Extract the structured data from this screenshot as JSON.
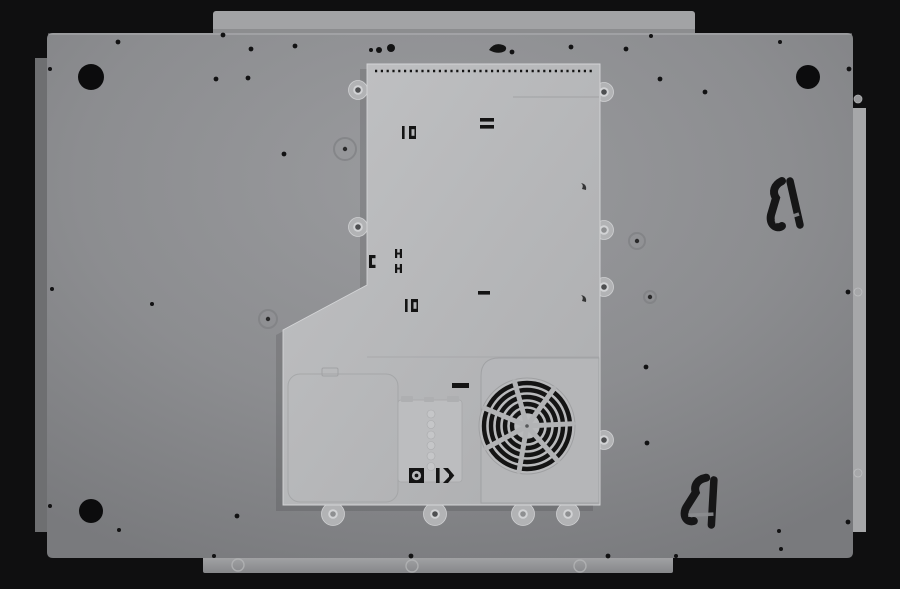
{
  "colors": {
    "bg": "#0f0f10",
    "panel-light": "#9a9b9e",
    "panel-mid": "#8c8d90",
    "panel-dark": "#7b7c7f",
    "flange-left": "#6e6f71",
    "flange-right": "#a6a7a9",
    "strip-top": "#a2a3a5",
    "strip-bottom-light": "#a4a5a7",
    "strip-bottom-dark": "#8a8b8d",
    "enclosure-light": "#bfc0c2",
    "enclosure-mid": "#b2b3b5",
    "plate": "#b6b7b9",
    "junction-cover": "#bcbdbf",
    "seam": "#9fa0a2",
    "edge-highlight": "#d6d7d9",
    "cutout-black": "#141414",
    "screw-ring": "#d2d3d5",
    "screw-dark": "#4e4f51",
    "screw-light": "#8e8f91"
  },
  "geometry": {
    "stage": {
      "w": 900,
      "h": 589
    },
    "glass_strip_top": {
      "x": 213,
      "y": 11,
      "w": 482,
      "h": 23
    },
    "glass_strip_bottom": {
      "x": 203,
      "y": 556,
      "w": 470,
      "h": 17,
      "notches": [
        [
          238,
          565
        ],
        [
          412,
          566
        ],
        [
          580,
          566
        ]
      ]
    },
    "corner_holes": [
      [
        91,
        77,
        13
      ],
      [
        808,
        77,
        12
      ],
      [
        91,
        511,
        12
      ]
    ],
    "screw_dots": [
      [
        118,
        42,
        2.4
      ],
      [
        223,
        35,
        2.4
      ],
      [
        251,
        49,
        2.4
      ],
      [
        295,
        46,
        2.4
      ],
      [
        50,
        69,
        2
      ],
      [
        216,
        79,
        2.4
      ],
      [
        248,
        78,
        2.4
      ],
      [
        284,
        154,
        2.4
      ],
      [
        152,
        304,
        2
      ],
      [
        52,
        289,
        2
      ],
      [
        50,
        506,
        2
      ],
      [
        119,
        530,
        2
      ],
      [
        237,
        516,
        2.4
      ],
      [
        214,
        556,
        2
      ],
      [
        411,
        556,
        2.4
      ],
      [
        608,
        556,
        2.4
      ],
      [
        676,
        556,
        2
      ],
      [
        781,
        549,
        2
      ],
      [
        848,
        522,
        2.4
      ],
      [
        779,
        531,
        2
      ],
      [
        371,
        50,
        2
      ],
      [
        379,
        50,
        3
      ],
      [
        391,
        48,
        4
      ],
      [
        512,
        52,
        2.4
      ],
      [
        571,
        47,
        2.4
      ],
      [
        626,
        49,
        2.4
      ],
      [
        651,
        36,
        2
      ],
      [
        660,
        79,
        2.4
      ],
      [
        705,
        92,
        2.4
      ],
      [
        780,
        42,
        2
      ],
      [
        849,
        69,
        2.4
      ],
      [
        848,
        292,
        2.4
      ],
      [
        646,
        367,
        2.4
      ],
      [
        647,
        443,
        2.4
      ],
      [
        525,
        183,
        2
      ],
      [
        470,
        218,
        2
      ],
      [
        520,
        238,
        2
      ],
      [
        492,
        383,
        2
      ],
      [
        468,
        403,
        2
      ],
      [
        403,
        470,
        1.6
      ],
      [
        572,
        463,
        2.4
      ],
      [
        582,
        502,
        2
      ]
    ],
    "embossed_rings": [
      [
        345,
        149,
        11
      ],
      [
        268,
        319,
        9
      ],
      [
        637,
        241,
        8
      ],
      [
        650,
        297,
        6
      ]
    ],
    "vent_row": {
      "x1": 375,
      "x2": 592,
      "y": 71
    },
    "enclosure": {
      "points": "367,64 600,64 600,505 283,505 283,330 367,285"
    },
    "tabs": {
      "left": [
        [
          358,
          90,
          "dark"
        ],
        [
          358,
          227,
          "dark"
        ]
      ],
      "right": [
        [
          604,
          92,
          "dark"
        ],
        [
          604,
          230,
          "light"
        ],
        [
          604,
          287,
          "dark"
        ],
        [
          604,
          440,
          "dark"
        ]
      ],
      "feet": [
        [
          333,
          514,
          "light"
        ],
        [
          435,
          514,
          "dark"
        ],
        [
          523,
          514,
          "light"
        ],
        [
          568,
          514,
          "light"
        ]
      ]
    },
    "fan": {
      "cx": 527,
      "cy": 426,
      "outer_r": 48,
      "ring_radii": [
        15,
        22,
        29,
        36,
        43
      ],
      "ring_width": 4.4,
      "spokes": 7,
      "spoke_width": 5,
      "angle_offset": 100
    },
    "brackets": [
      {
        "x": 783,
        "y": 207,
        "rot": 0
      },
      {
        "x": 700,
        "y": 503,
        "rot": 16
      }
    ],
    "junction_bumps": {
      "cx": 431,
      "y0": 414,
      "step": 10.5,
      "count": 6,
      "r": 4
    },
    "flange_right_notches": [
      [
        858,
        99
      ],
      [
        858,
        292
      ],
      [
        858,
        473
      ]
    ]
  }
}
